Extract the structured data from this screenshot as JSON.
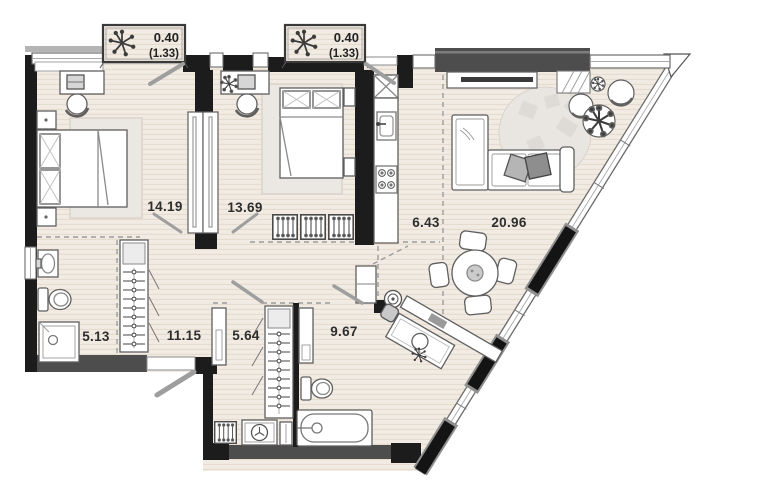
{
  "plan": {
    "type": "apartment-floor-plan",
    "rooms": {
      "bedroom_1": "14.19",
      "bedroom_2": "13.69",
      "kitchen": "6.43",
      "living_room": "20.96",
      "bathroom_1": "5.13",
      "hallway": "11.15",
      "dressing_corridor": "5.64",
      "bathroom_2": "9.67"
    },
    "balconies": [
      {
        "area": "0.40",
        "coefficient_area": "(1.33)"
      },
      {
        "area": "0.40",
        "coefficient_area": "(1.33)"
      }
    ],
    "colors": {
      "floor": "#f2ebe3",
      "floor_line": "#e4dacd",
      "wall": "#1c1c1c",
      "wall_gray": "#4d4d4d",
      "facade_gray": "#b4b4b4",
      "outline": "#5f5f5f",
      "swing": "#9e9e9e",
      "label": "#2e2e2e",
      "rug": "#e9e6e2",
      "pillow_dark": "#8e8e8e",
      "pillow_light": "#b5b5b5"
    }
  }
}
